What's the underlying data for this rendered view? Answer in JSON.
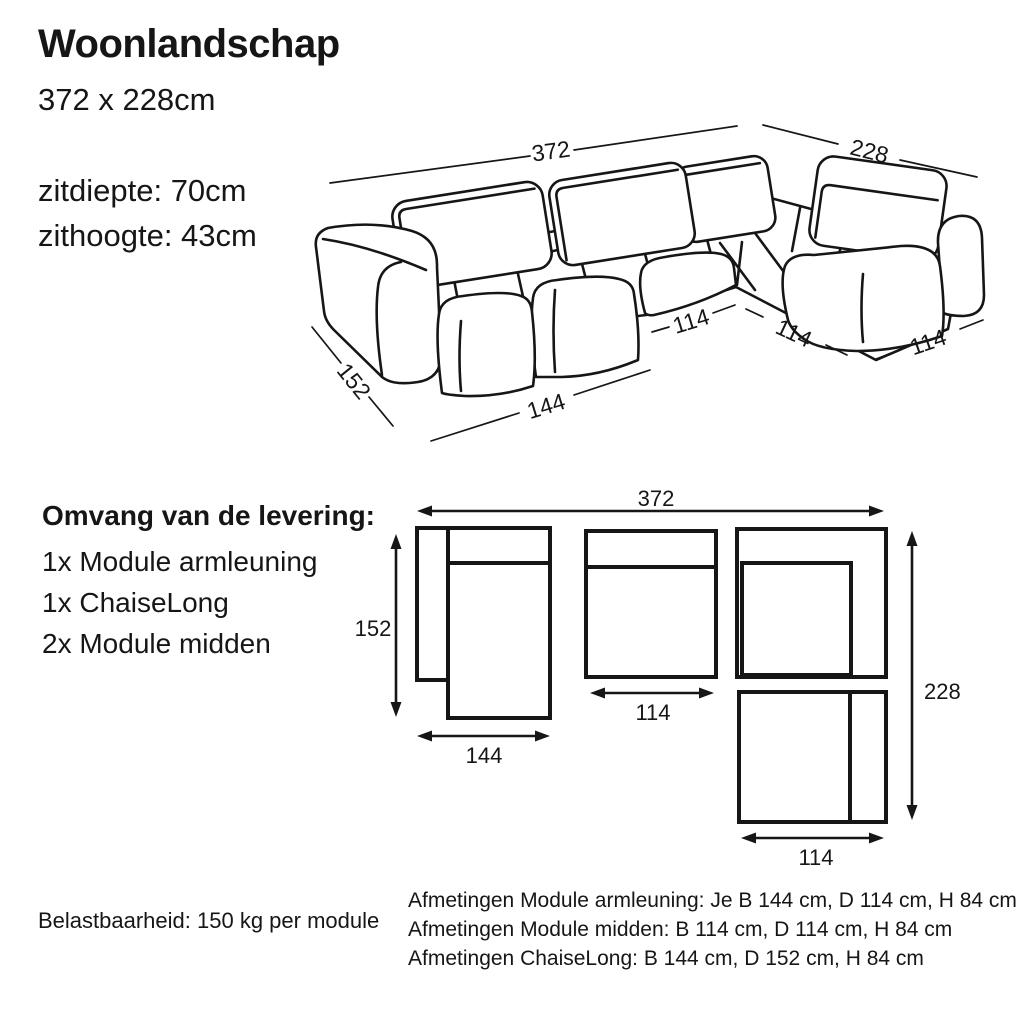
{
  "colors": {
    "ink": "#161616",
    "background": "#ffffff"
  },
  "header": {
    "title": "Woonlandschap",
    "size": "372 x 228cm",
    "seat_depth": "zitdiepte: 70cm",
    "seat_height": "zithoogte: 43cm"
  },
  "sofa_diagram": {
    "labels": {
      "total_width": "372",
      "total_depth": "228",
      "chaise_depth": "152",
      "chaise_width": "144",
      "module_width_left": "114",
      "module_width_corner": "114",
      "module_width_right": "114"
    }
  },
  "delivery": {
    "heading": "Omvang van de levering:",
    "items": [
      "1x Module armleuning",
      "1x ChaiseLong",
      "2x Module midden"
    ]
  },
  "floorplan": {
    "labels": {
      "total_width": "372",
      "chaise_depth": "152",
      "chaise_width": "144",
      "middle_module_width": "114",
      "total_depth": "228",
      "corner_module_width": "114"
    }
  },
  "footer": {
    "load": "Belastbaarheid: 150 kg per module",
    "dims": [
      "Afmetingen Module armleuning: Je B 144 cm, D 114 cm, H 84 cm",
      "Afmetingen Module midden: B 114 cm, D 114 cm, H 84 cm",
      "Afmetingen ChaiseLong: B 144 cm, D 152 cm, H 84 cm"
    ]
  }
}
